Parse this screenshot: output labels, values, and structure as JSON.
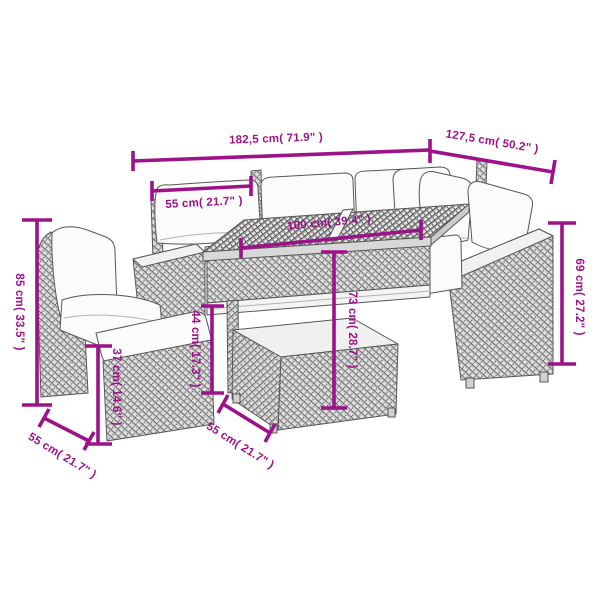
{
  "diagram": {
    "accent_color": "#9D1189",
    "background_color": "#ffffff",
    "illustration": "rattan-corner-sofa-set-with-chair-ottoman-and-slatted-table",
    "furniture_fill_color": "#e6e6e6",
    "cushion_color": "#fbfbfb",
    "outline_color": "#565656"
  },
  "dimensions": {
    "overall_width": {
      "label": "182,5 cm( 71.9\" )",
      "cm": 182.5,
      "inch": 71.9
    },
    "right_width": {
      "label": "127,5 cm( 50.2\" )",
      "cm": 127.5,
      "inch": 50.2
    },
    "seat_width": {
      "label": "55 cm( 21.7\" )",
      "cm": 55,
      "inch": 21.7
    },
    "table_length": {
      "label": "100 cm( 39.4\" )",
      "cm": 100,
      "inch": 39.4
    },
    "back_height": {
      "label": "85 cm( 33.5\" )",
      "cm": 85,
      "inch": 33.5
    },
    "seat_height": {
      "label": "37 cm( 14.6\" )",
      "cm": 37,
      "inch": 14.6
    },
    "shelf_height": {
      "label": "44 cm( 17.3\" )",
      "cm": 44,
      "inch": 17.3
    },
    "table_height": {
      "label": "73 cm( 28.7\" )",
      "cm": 73,
      "inch": 28.7
    },
    "arm_height": {
      "label": "69 cm( 27.2\" )",
      "cm": 69,
      "inch": 27.2
    },
    "depth_left": {
      "label": "55 cm( 21.7\" )",
      "cm": 55,
      "inch": 21.7
    },
    "depth_center": {
      "label": "55 cm( 21.7\" )",
      "cm": 55,
      "inch": 21.7
    }
  }
}
